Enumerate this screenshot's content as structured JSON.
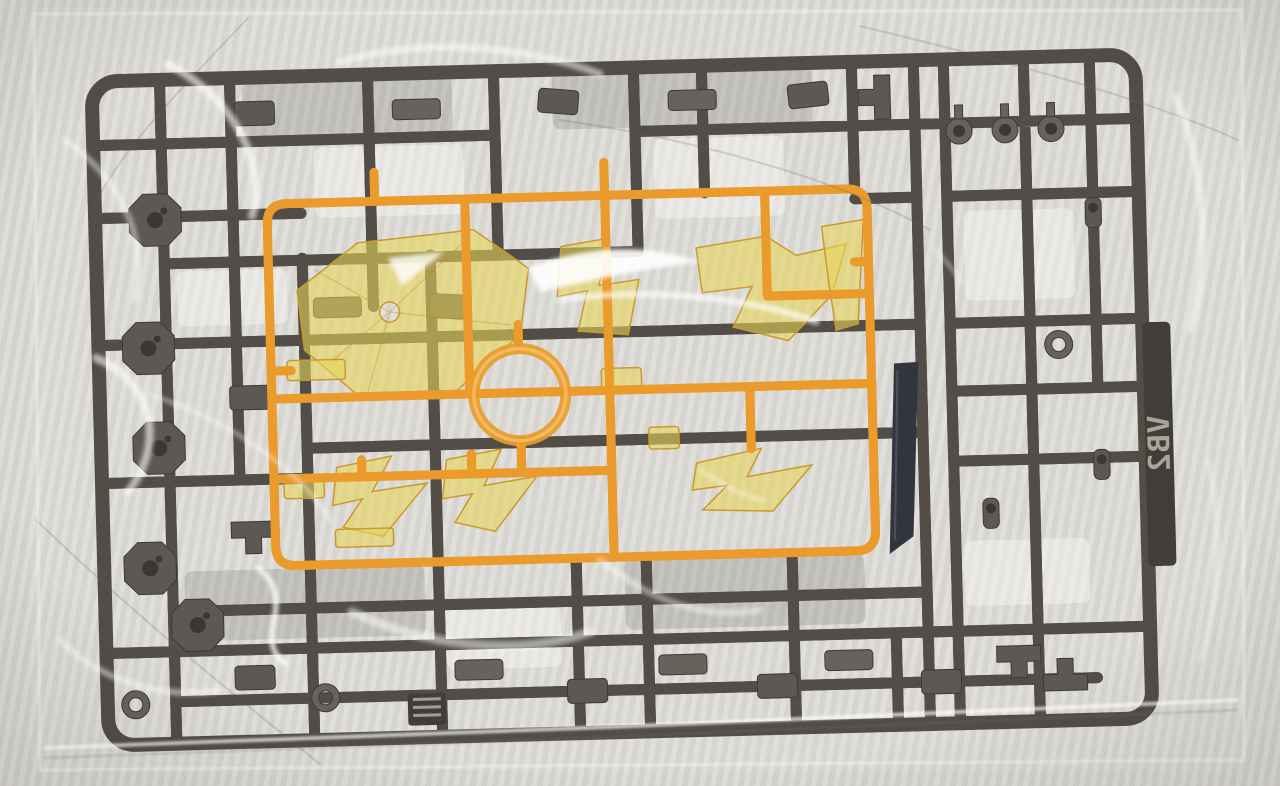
{
  "scene": {
    "alt": "Plastic model kit runner sprue sealed in a clear plastic bag",
    "tag_label": "VB2"
  },
  "colors": {
    "background": "#d9d7d2",
    "dark_runner": "#454039",
    "dark_runner_deep": "#332f2a",
    "dark_part": "#514c46",
    "dark_part_light": "#5d5751",
    "hole": "#2b2926",
    "orange_runner": "#e8941c",
    "orange_highlight": "#f8bc5c",
    "clear_yellow": "#e6d24a",
    "blade_dark": "#232630",
    "tag_text": "#b9b2a6"
  }
}
